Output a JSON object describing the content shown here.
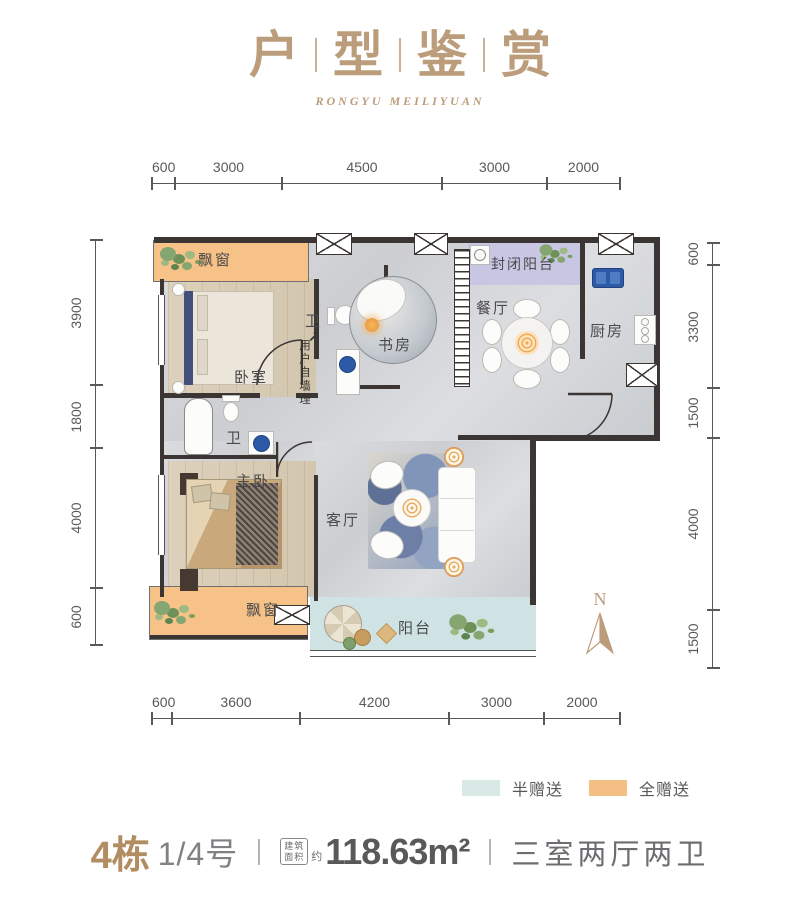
{
  "header": {
    "title_chars": [
      "户",
      "型",
      "鉴",
      "赏"
    ],
    "subtitle": "RONGYU MEILIYUAN"
  },
  "dimensions": {
    "top": [
      "600",
      "3000",
      "4500",
      "3000",
      "2000"
    ],
    "bottom": [
      "600",
      "3600",
      "4200",
      "3000",
      "2000"
    ],
    "left": [
      "3900",
      "1800",
      "4000",
      "600"
    ],
    "right": [
      "600",
      "3300",
      "1500",
      "4000",
      "1500"
    ]
  },
  "rooms": {
    "bay_window_top": "飘窗",
    "bedroom": "卧室",
    "bath1": "卫",
    "study": "书房",
    "enclosed_balcony": "封闭阳台",
    "dining": "餐厅",
    "kitchen": "厨房",
    "bath2": "卫",
    "master_bedroom": "主卧",
    "bay_window_bottom": "飘窗",
    "living": "客厅",
    "balcony": "阳台"
  },
  "annotations": {
    "wall_note": "用户自墙理",
    "wall_note_arrow": "↗",
    "compass": "N"
  },
  "legend": [
    {
      "label": "半赠送",
      "color": "#d9e9e6"
    },
    {
      "label": "全赠送",
      "color": "#f3bf85"
    }
  ],
  "footer": {
    "building": "4栋",
    "unit": "1/4号",
    "area_label_top": "建筑",
    "area_label_bottom": "面积",
    "approx": "约",
    "area": "118.63m²",
    "layout": "三室两厅两卫"
  },
  "colors": {
    "gold": "#bc9d7b",
    "dimension": "#58595b",
    "wall": "#3b3633",
    "full_gift_orange": "#f6c287",
    "enclosed_balcony_lavender": "#c8c6e2",
    "balcony_cyan": "#d0e3e4"
  }
}
